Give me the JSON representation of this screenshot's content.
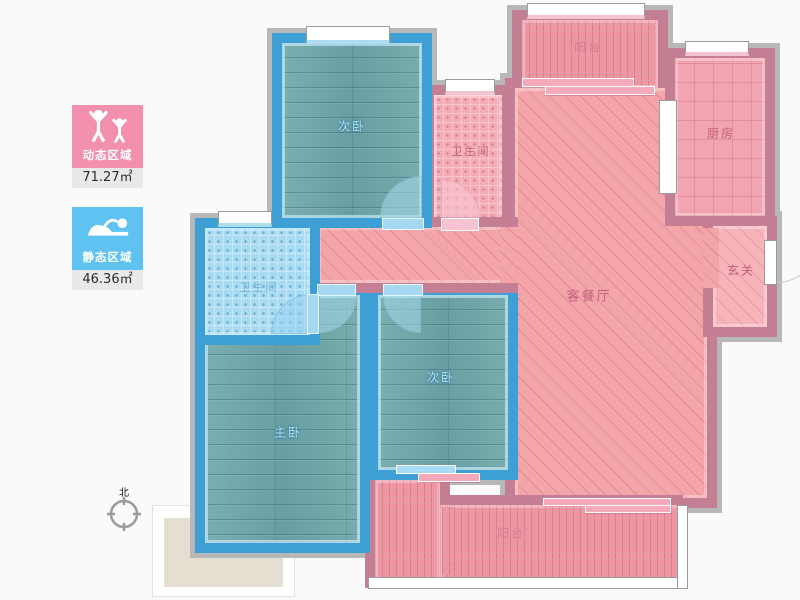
{
  "legend": {
    "dynamic_area": {
      "label": "动态区域",
      "value": "71.27",
      "unit": "㎡"
    },
    "static_area": {
      "label": "静态区域",
      "value": "46.36",
      "unit": "㎡"
    }
  },
  "compass": {
    "north_label": "北"
  },
  "rooms": {
    "bedroom_top_left": {
      "label": "次卧"
    },
    "bathroom_top": {
      "label": "卫生间"
    },
    "balcony_top": {
      "label": "阳台"
    },
    "kitchen": {
      "label": "厨房"
    },
    "living_dining": {
      "label": "客餐厅"
    },
    "foyer": {
      "label": "玄关"
    },
    "bathroom_left": {
      "label": "卫生间"
    },
    "master_bedroom": {
      "label": "主卧"
    },
    "bedroom_center": {
      "label": "次卧"
    },
    "balcony_bottom": {
      "label": "阳台"
    }
  },
  "colors": {
    "dynamic_pink": "#f390ad",
    "static_blue": "#5fc2f0",
    "wall_blue": "#3d9fd3",
    "wall_mauve": "#c57f94",
    "floor_teal": "#73a8ab",
    "floor_pink_hatch": "#f4a5a9",
    "bath_blue_floor": "#a8dbf2",
    "shadow_gray": "#b8b8b8"
  }
}
